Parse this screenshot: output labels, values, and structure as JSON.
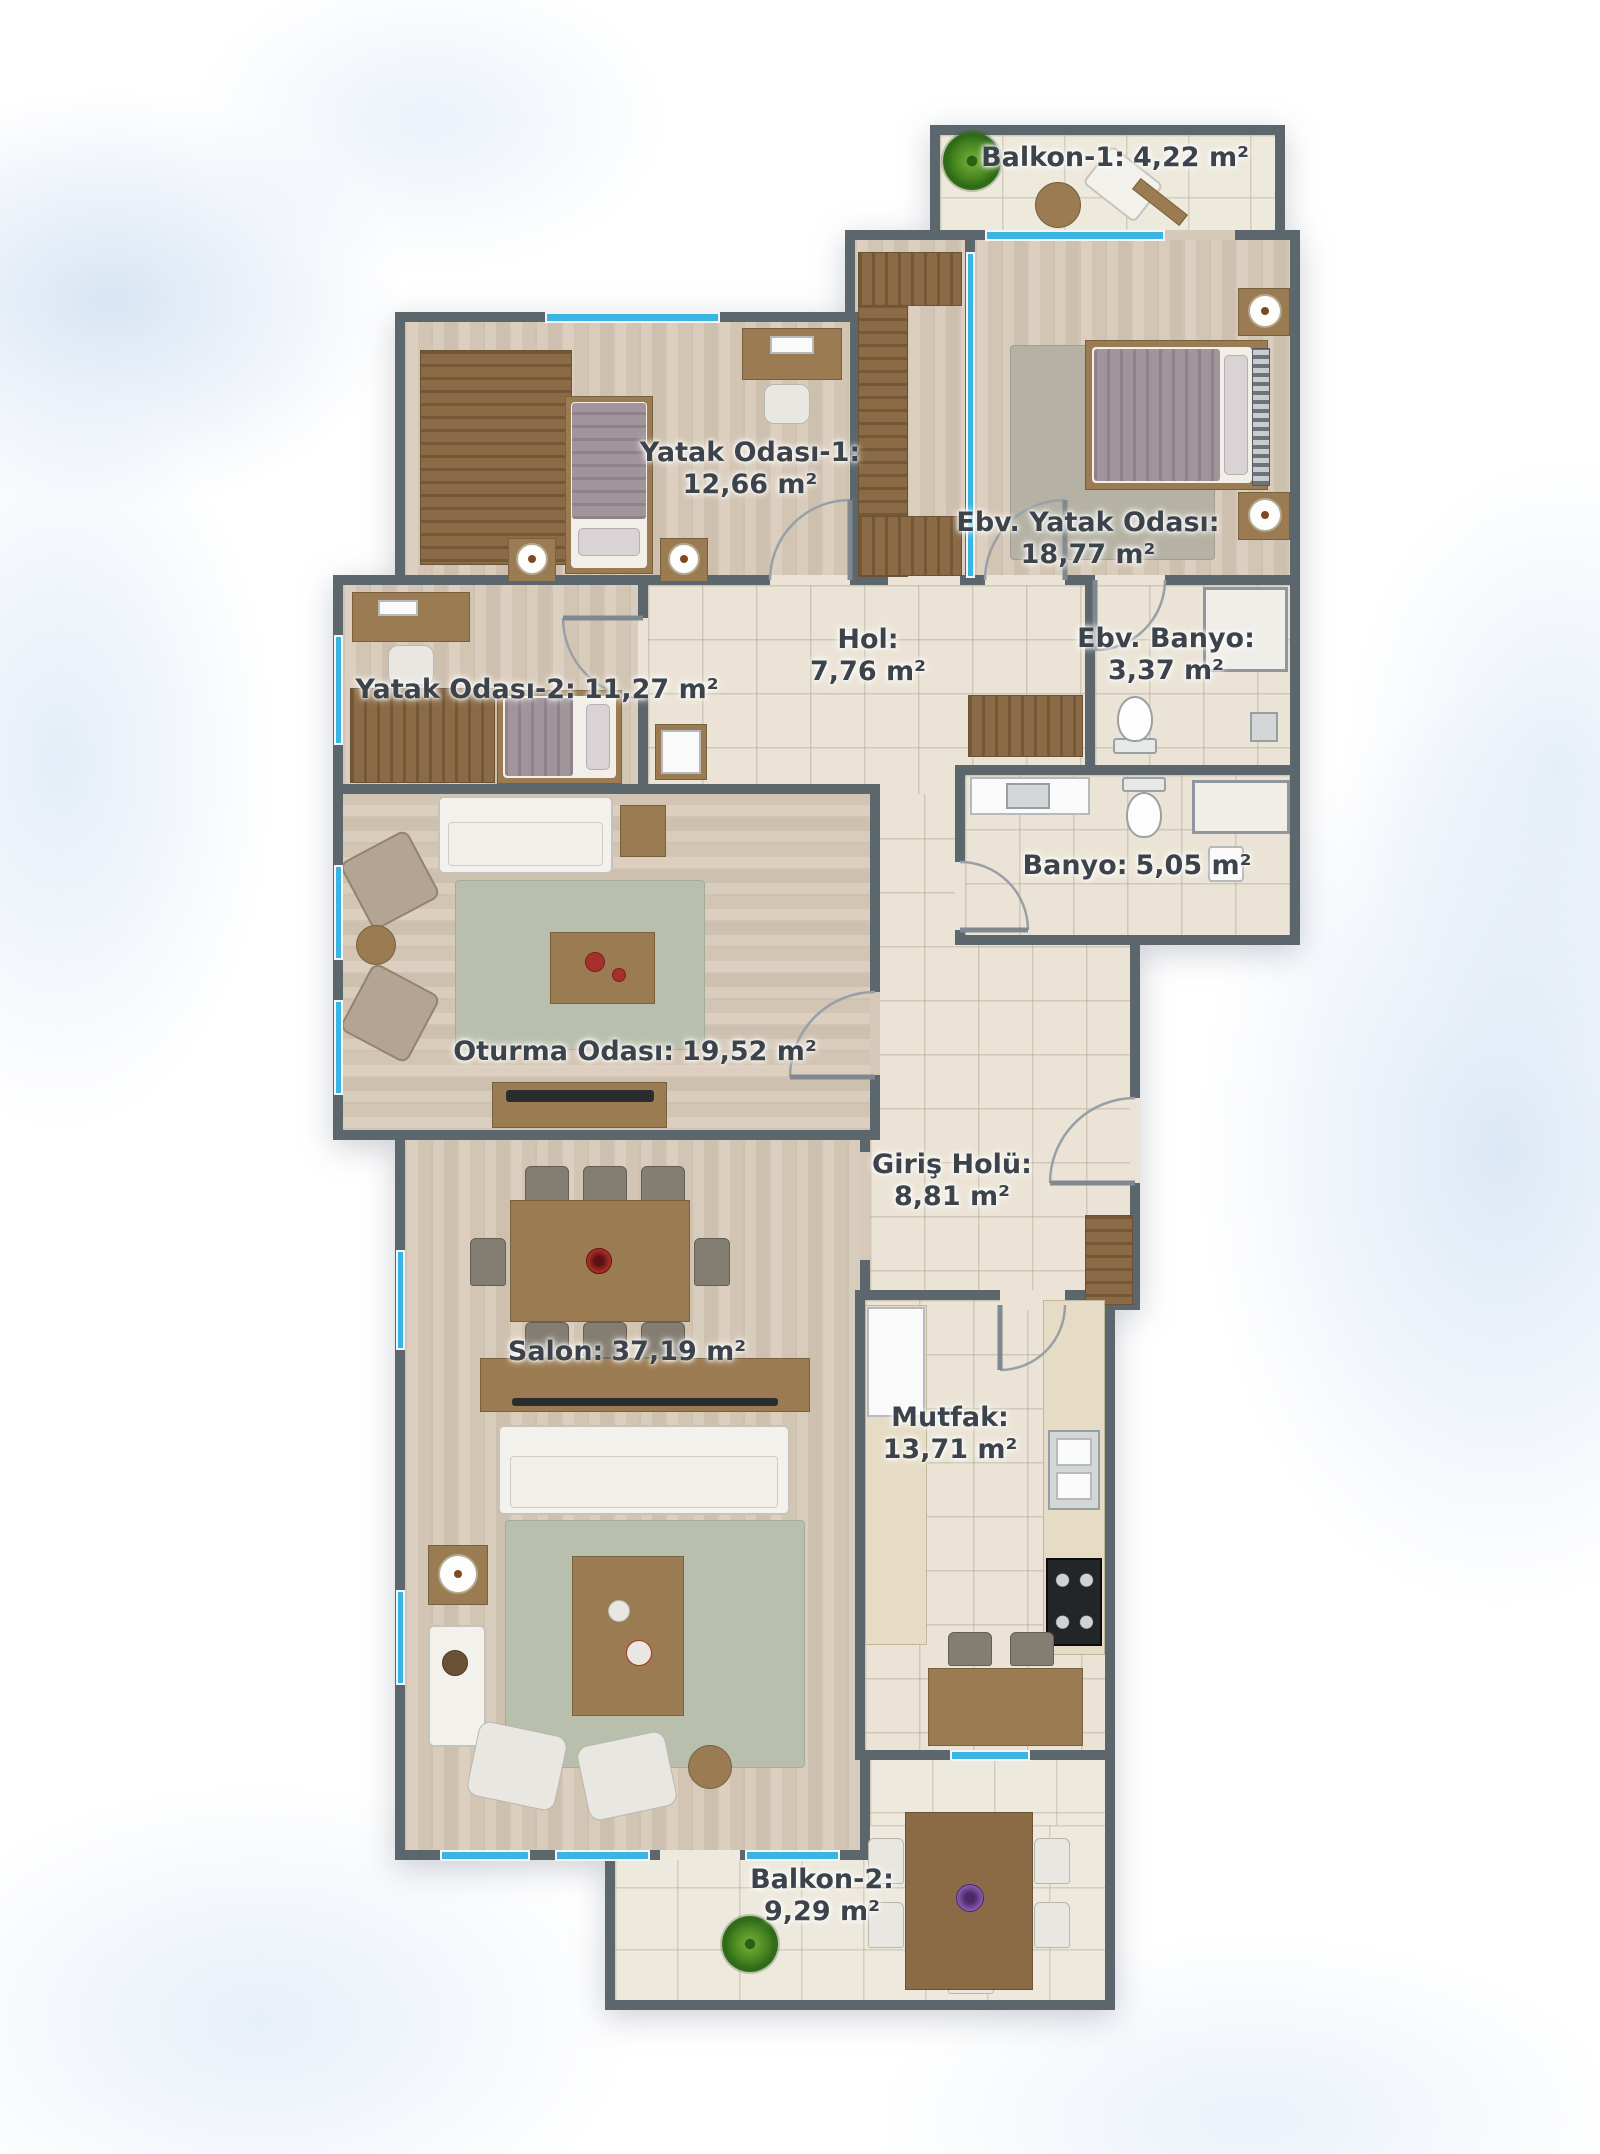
{
  "rooms": {
    "balkon1": {
      "name": "Balkon-1:",
      "area": "4,22 m²"
    },
    "yatak1": {
      "name": "Yatak Odası-1:",
      "area": "12,66 m²"
    },
    "ebv_yatak": {
      "name": "Ebv. Yatak Odası:",
      "area": "18,77 m²"
    },
    "yatak2": {
      "name": "Yatak Odası-2:",
      "area": "11,27 m²"
    },
    "hol": {
      "name": "Hol:",
      "area": "7,76 m²"
    },
    "ebv_banyo": {
      "name": "Ebv. Banyo:",
      "area": "3,37 m²"
    },
    "banyo": {
      "name": "Banyo:",
      "area": "5,05 m²"
    },
    "oturma": {
      "name": "Oturma Odası:",
      "area": "19,52 m²"
    },
    "giris": {
      "name": "Giriş Holü:",
      "area": "8,81 m²"
    },
    "salon": {
      "name": "Salon:",
      "area": "37,19 m²"
    },
    "mutfak": {
      "name": "Mutfak:",
      "area": "13,71 m²"
    },
    "balkon2": {
      "name": "Balkon-2:",
      "area": "9,29 m²"
    }
  },
  "colors": {
    "wall": "#5c666d",
    "window_glass": "#39b4e3",
    "label_text": "#3c434b",
    "wood_floor": "#d6c9b9",
    "tile_floor": "#ebe4d6"
  }
}
